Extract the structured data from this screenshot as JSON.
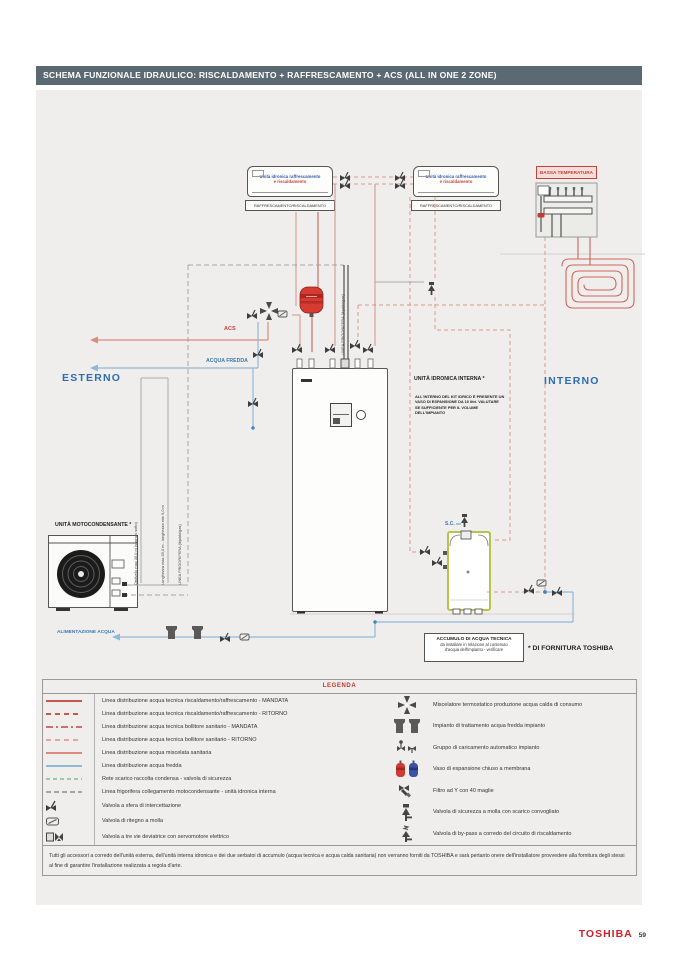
{
  "page": {
    "title": "SCHEMA FUNZIONALE IDRAULICO: RISCALDAMENTO + RAFFRESCAMENTO + ACS (ALL IN ONE 2 ZONE)",
    "brand": "TOSHIBA",
    "page_number": "59"
  },
  "colors": {
    "header_bg": "#5b6a72",
    "brand_red": "#cc1f2a",
    "label_red": "#c0443c",
    "label_blue": "#2e6db4",
    "line_heating": "#c4574e",
    "line_cold_water": "#8fb9d9",
    "line_condensate": "#9ccaa8",
    "line_refrigerant": "#a5a5a5",
    "tank_border": "#b9c24d"
  },
  "diagram": {
    "zone_esterno": "ESTERNO",
    "zone_interno": "INTERNO",
    "fancoil": {
      "line1": "Unità idronica raffrescamento",
      "line2": "e riscaldamento",
      "tag": "RAFFRESCAMENTO/RISCALDAMENTO"
    },
    "bassa_temperatura": "BASSA TEMPERATURA",
    "unita_idronica_interna": "UNITÀ IDRONICA INTERNA *",
    "kit_note": "ALL'INTERNO DEL KIT IDRICO È PRESENTE UN VASO DI ESPANSIONE DA 10 litri. VALUTARE SE SUFFICIENTE PER IL VOLUME DELL'IMPIANTO",
    "unita_motocondensante": "UNITÀ MOTOCONDENSANTE *",
    "acs": "ACS",
    "acqua_fredda": "ACQUA FREDDA",
    "alimentazione_acqua": "ALIMENTAZIONE ACQUA",
    "sc": "S.C.",
    "dislivello": "Dislivello max 30,0 m (sopra o sotto)",
    "lunghezza": "Lunghezza max 30,0 m - lunghezza min 5,0 m",
    "linea_frigorifera": "LINEA FRIGORIFERA (liquido/gas)",
    "accumulo": {
      "line1": "ACCUMULO DI ACQUA TECNICA",
      "line2": "da installare in relazione al contenuto",
      "line3": "d'acqua dell'impianto - verificare"
    },
    "fornitura": "* DI FORNITURA TOSHIBA"
  },
  "legend": {
    "title": "LEGENDA",
    "left": [
      {
        "label": "Linea distribuzione acqua tecnica riscaldamento/raffrescamento - MANDATA"
      },
      {
        "label": "Linea distribuzione acqua tecnica riscaldamento/raffrescamento - RITORNO"
      },
      {
        "label": "Linea distribuzione acqua tecnica bollitore sanitario - MANDATA"
      },
      {
        "label": "Linea distribuzione acqua tecnica bollitore sanitario - RITORNO"
      },
      {
        "label": "Linea distribuzione acqua miscelata sanitaria"
      },
      {
        "label": "Linea distribuzione acqua fredda"
      },
      {
        "label": "Rete scarico raccolta condensa - valvola di sicurezza"
      },
      {
        "label": "Linea frigorifera collegamento motocondensante - unità idronica interna"
      },
      {
        "label": "Valvola a sfera di intercettazione"
      },
      {
        "label": "Valvola di ritegno a molla"
      },
      {
        "label": "Valvola a tre vie deviatrice con servomotore elettrico"
      }
    ],
    "right": [
      {
        "label": "Miscelatore termostatico produzione acqua calda di consumo"
      },
      {
        "label": "Impianto di trattamento acqua fredda impianto"
      },
      {
        "label": "Gruppo di caricamento automatico impianto"
      },
      {
        "label": "Vaso di espansione chiuso a membrana"
      },
      {
        "label": "Filtro ad Y con 40 maglie"
      },
      {
        "label": "Valvola di sicurezza a molla con scarico convogliato"
      },
      {
        "label": "Valvola di by-pass a corredo del circuito di riscaldamento"
      }
    ],
    "note": "Tutti gli accessori a corredo dell'unità esterna, dell'unità interna idronica e dei due serbatoi di accumulo (acqua tecnica e acqua calda sanitaria) non verranno forniti da TOSHIBA e sarà pertanto onere dell'installatore provvedere alla fornitura degli stessi al fine di garantire l'installazione realizzata a regola d'arte."
  }
}
